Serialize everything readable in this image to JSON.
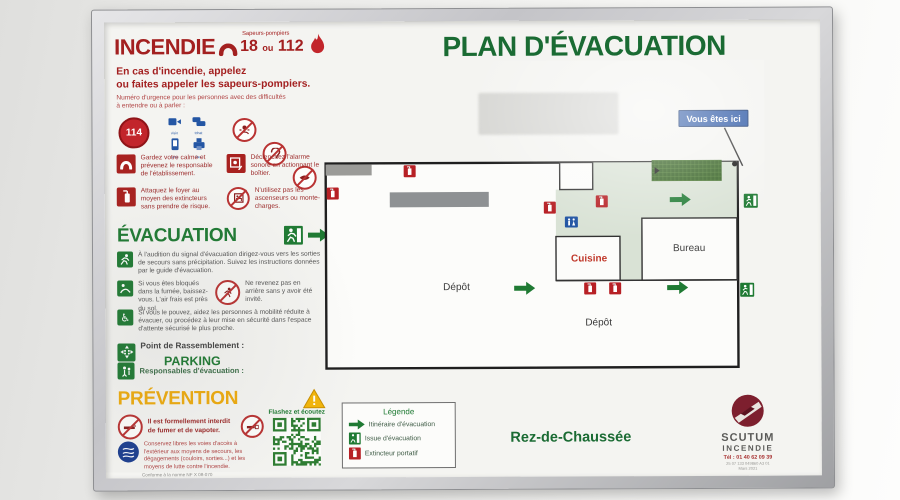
{
  "colors": {
    "red": "#a32020",
    "green": "#1f7a33",
    "title_green": "#1a6b33",
    "yellow": "#eeab0e",
    "blue_badge": "#2b57a5",
    "corridor": "#d9e2d5",
    "rack": "#2f5c1d",
    "extinguisher_red": "#b72025"
  },
  "header": {
    "title": "PLAN D'ÉVACUATION",
    "incendie": "INCENDIE",
    "sapeurs": "Sapeurs-pompiers",
    "num_18": "18",
    "num_ou": "ou",
    "num_112": "112",
    "line1": "En cas d'incendie, appelez",
    "line2": "ou faites appeler les sapeurs-pompiers.",
    "notice1": "Numéro d'urgence pour les personnes avec des difficultés",
    "notice2": "à entendre ou à parler :",
    "num114": "114",
    "channels": {
      "0": "visio",
      "1": "tchat",
      "2": "sms",
      "3": "fax"
    }
  },
  "consignes": {
    "0": "Gardez votre calme et prévenez le responsable de l'établissement.",
    "1": "Déclenchez l'alarme sonore en actionnant le boîtier.",
    "2": "Attaquez le foyer au moyen des extincteurs sans prendre de risque.",
    "3": "N'utilisez pas les ascenseurs ou monte-charges."
  },
  "evacuation": {
    "title": "ÉVACUATION",
    "item1": "À l'audition du signal d'évacuation dirigez-vous vers les sorties de secours sans précipitation. Suivez les instructions données par le guide d'évacuation.",
    "item2": "Si vous êtes bloqués dans la fumée, baissez-vous. L'air frais est près du sol.",
    "item2b": "Ne revenez pas en arrière sans y avoir été invité.",
    "item3": "Si vous le pouvez, aidez les personnes à mobilité réduite à évacuer, ou procédez à leur mise en sécurité dans l'espace d'attente sécurisé le plus proche.",
    "rassemblement_label": "Point de Rassemblement :",
    "rassemblement_value": "PARKING",
    "responsables_label": "Responsables d'évacuation :"
  },
  "prevention": {
    "title": "PRÉVENTION",
    "smoking": "Il est formellement interdit de fumer et de vapoter.",
    "acces": "Conservez libres les voies d'accès à l'extérieur aux moyens de secours, les dégagements (couloirs, sorties...) et les moyens de lutte contre l'incendie.",
    "conforme": "Conforme à la norme NF X 08-070",
    "qr_label": "Flashez et écoutez"
  },
  "plan": {
    "you_are_here": "Vous êtes ici",
    "floor": "Rez-de-Chaussée",
    "room_depot1": "Dépôt",
    "room_cuisine": "Cuisine",
    "room_bureau": "Bureau",
    "room_depot2": "Dépôt"
  },
  "legend": {
    "title": "Légende",
    "itineraire": "Itinéraire d'évacuation",
    "issue": "Issue d'évacuation",
    "extincteur": "Extincteur portatif"
  },
  "footer": {
    "brand1": "SCUTUM",
    "brand2": "INCENDIE",
    "phone": "Tél : 01 40 62 09 39",
    "ref": "25 07 133 049860 A3 01",
    "date": "Mars 2021"
  }
}
